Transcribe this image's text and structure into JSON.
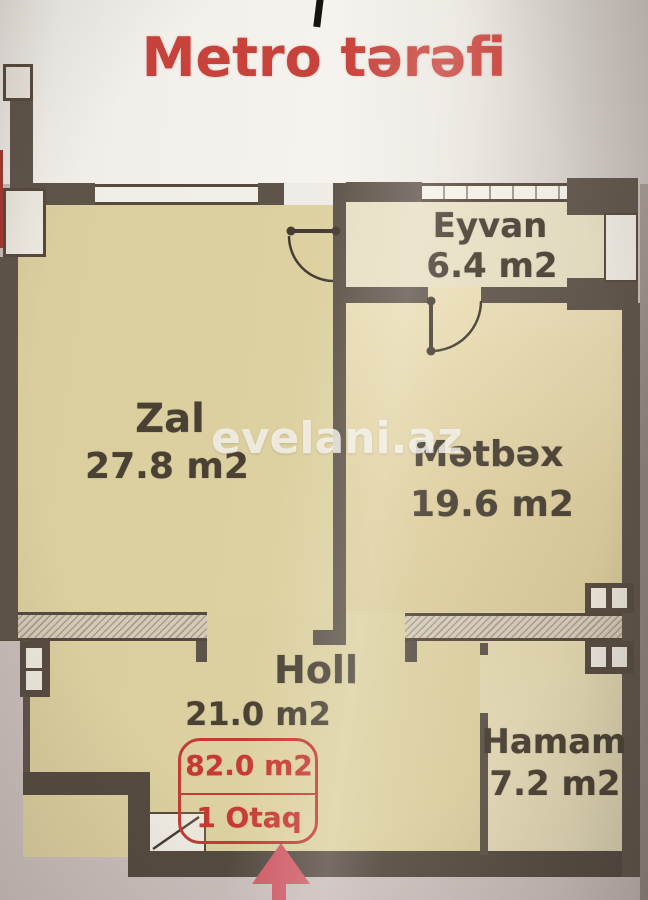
{
  "floorplan": {
    "direction_label": "Metro tərəfi",
    "watermark": "evelani.az",
    "rooms": {
      "zal": {
        "name": "Zal",
        "area": "27.8 m2"
      },
      "eyvan": {
        "name": "Eyvan",
        "area": "6.4 m2"
      },
      "metbex": {
        "name": "Mətbəx",
        "area": "19.6 m2"
      },
      "holl": {
        "name": "Holl",
        "area": "21.0 m2"
      },
      "hamam": {
        "name": "Hamam",
        "area": "7.2 m2"
      }
    },
    "summary": {
      "total_area": "82.0 m2",
      "room_count": "1 Otaq"
    }
  },
  "colors": {
    "accent_red": "#c53a31",
    "title_red": "#c7423b",
    "arrow_red": "#d15a66",
    "wall": "#5e544a",
    "floor_khaki": "#ddd1a1",
    "outside_white": "#f3f0eb",
    "outside_gray": "#cbc0bd"
  }
}
